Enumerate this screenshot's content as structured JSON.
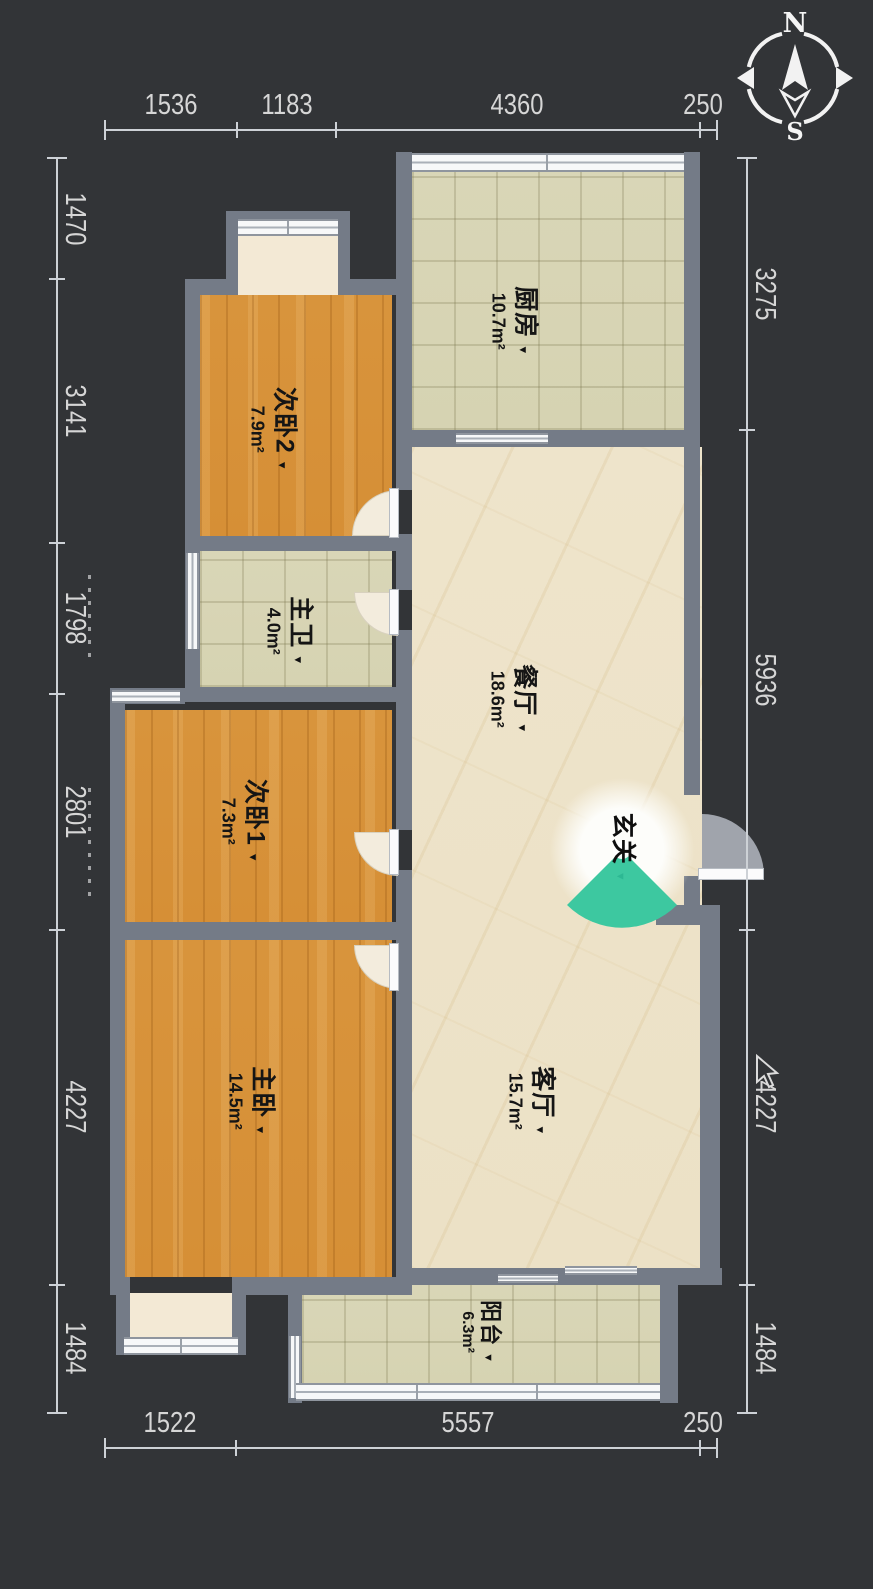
{
  "compass": {
    "north_label": "N",
    "south_label": "S"
  },
  "icons": {
    "dropdown": "▼"
  },
  "rooms": {
    "kitchen": {
      "name": "厨房",
      "area": "10.7m²"
    },
    "bedroom2": {
      "name": "次卧2",
      "area": "7.9m²"
    },
    "bath": {
      "name": "主卫",
      "area": "4.0m²"
    },
    "dining": {
      "name": "餐厅",
      "area": "18.6m²"
    },
    "bedroom1": {
      "name": "次卧1",
      "area": "7.3m²"
    },
    "foyer": {
      "name": "玄关"
    },
    "master": {
      "name": "主卧",
      "area": "14.5m²"
    },
    "living": {
      "name": "客厅",
      "area": "15.7m²"
    },
    "balcony": {
      "name": "阳台",
      "area": "6.3m²"
    }
  },
  "dimensions": {
    "top": [
      "1536",
      "1183",
      "4360",
      "250"
    ],
    "bottom": [
      "1522",
      "5557",
      "250"
    ],
    "left": [
      "1470",
      "3141",
      "1798",
      "2801",
      "4227",
      "1484"
    ],
    "right": [
      "3275",
      "5936",
      "4227",
      "1484"
    ]
  },
  "colors": {
    "background": "#323437",
    "wall": "#747b87",
    "wood_floor": "#d8943c",
    "tile_floor": "#d9d6b7",
    "marble_floor": "#eee4cb",
    "accent_teal": "#3dc8a0",
    "dimension_text": "#d6d6d6"
  }
}
